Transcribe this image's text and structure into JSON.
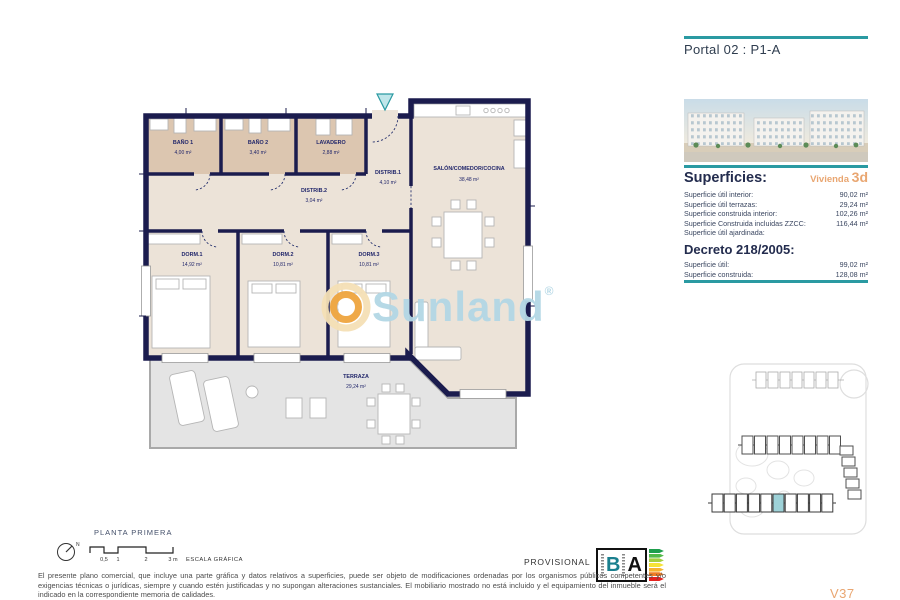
{
  "header": {
    "portal_title": "Portal 02 : P1-A"
  },
  "watermark": {
    "brand": "Sunland",
    "registered": "®"
  },
  "plan": {
    "title": "PLANTA PRIMERA",
    "rooms": {
      "banyo1": {
        "name": "BAÑO 1",
        "area": "4,00 m²"
      },
      "banyo2": {
        "name": "BAÑO 2",
        "area": "3,40 m²"
      },
      "lavadero": {
        "name": "LAVADERO",
        "area": "2,88 m²"
      },
      "distrib1": {
        "name": "DISTRIB.1",
        "area": "4,10 m²"
      },
      "distrib2": {
        "name": "DISTRIB.2",
        "area": "3,04 m²"
      },
      "salon": {
        "name": "SALÓN/COMEDOR/COCINA",
        "area": "38,48 m²"
      },
      "dorm1": {
        "name": "DORM.1",
        "area": "14,92 m²"
      },
      "dorm2": {
        "name": "DORM.2",
        "area": "10,81 m²"
      },
      "dorm3": {
        "name": "DORM.3",
        "area": "10,81 m²"
      },
      "terraza": {
        "name": "TERRAZA",
        "area": "29,24 m²"
      }
    }
  },
  "sidebar": {
    "superficies": {
      "heading": "Superficies:",
      "vivienda_prefix": "Vivienda",
      "vivienda_code": "3d",
      "rows": [
        {
          "label": "Superficie útil interior:",
          "value": "90,02 m²"
        },
        {
          "label": "Superficie útil terrazas:",
          "value": "29,24 m²"
        },
        {
          "label": "Superficie construida interior:",
          "value": "102,26 m²"
        },
        {
          "label": "Superficie Construida incluidas ZZCC:",
          "value": "116,44 m²"
        },
        {
          "label": "Superficie útil ajardinada:",
          "value": ""
        }
      ]
    },
    "decreto": {
      "heading": "Decreto 218/2005:",
      "rows": [
        {
          "label": "Superficie útil:",
          "value": "99,02 m²"
        },
        {
          "label": "Superficie construida:",
          "value": "128,08 m²"
        }
      ]
    },
    "version": "V37"
  },
  "footer": {
    "scale": {
      "north": "N",
      "ticks": [
        "0,5",
        "1",
        "2",
        "3 m"
      ],
      "label": "ESCALA GRÁFICA"
    },
    "provisional": "PROVISIONAL",
    "energy": {
      "letter_b": "B",
      "letter_a": "A"
    },
    "disclaimer": "El presente plano comercial, que incluye una parte gráfica y datos relativos a superficies, puede ser objeto de modificaciones ordenadas por los organismos públicos competentes y/o exigencias técnicas o jurídicas, siempre y cuando estén justificadas y no supongan alteraciones sustanciales. El mobiliario mostrado no está incluido y el equipamiento del inmueble será el indicado en la correspondiente memoria de calidades."
  },
  "colors": {
    "accent_teal": "#2A9AA2",
    "accent_orange": "#E9A671",
    "wall_navy": "#1B1C4E",
    "room_beige": "#ECE3D8",
    "wet_room_tan": "#DCC6B0",
    "terrace_gray": "#E4E4E4",
    "watermark_blue": "#B3D7E5",
    "energy_scale": [
      "#1E9E4C",
      "#53B948",
      "#A5CF3E",
      "#F6E337",
      "#F5B32F",
      "#EF7D23",
      "#E5231F"
    ]
  }
}
